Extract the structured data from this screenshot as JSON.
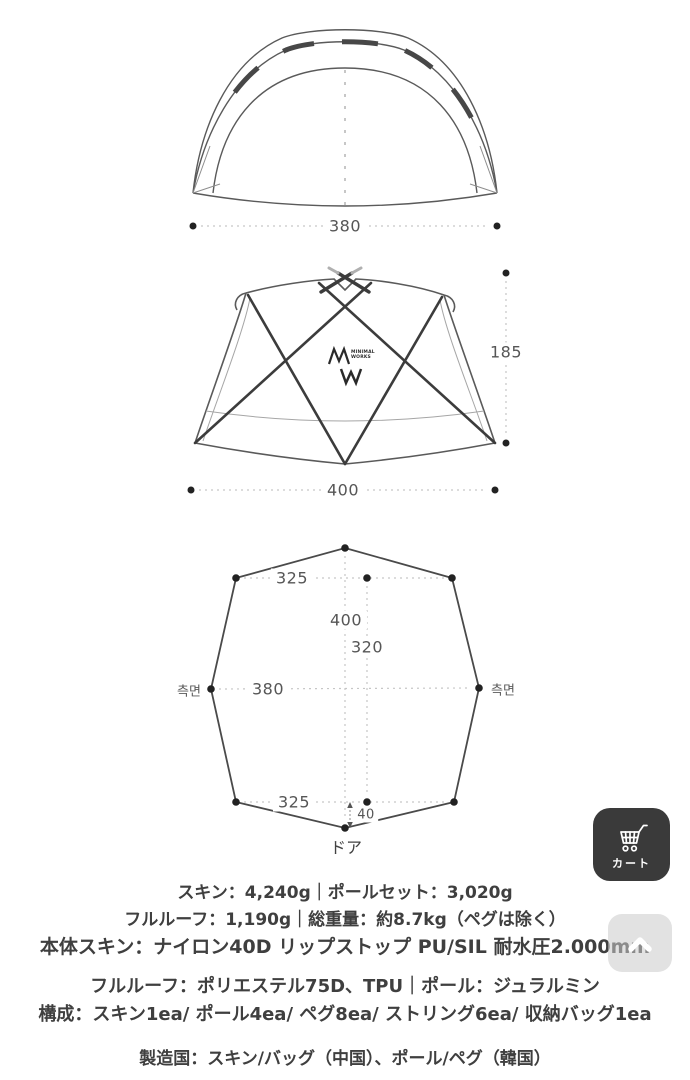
{
  "diagrams": {
    "front_view": {
      "width_dim": "380"
    },
    "side_view": {
      "height_dim": "185",
      "width_dim": "400",
      "logo_line1": "MINIMAL",
      "logo_line2": "WORKS"
    },
    "floor_plan": {
      "top_width_dim": "325",
      "length_dim": "400",
      "inner_length_dim": "320",
      "middle_width_dim": "380",
      "bottom_width_dim": "325",
      "door_offset_dim": "40",
      "side_label_left": "측면",
      "side_label_right": "측면",
      "door_label": "ドア"
    }
  },
  "specs": {
    "weight_line1": "スキン：4,240g｜ポールセット：3,020g",
    "weight_line2": "フルルーフ：1,190g｜総重量：約8.7kg（ペグは除く）",
    "material_line1": "本体スキン：ナイロン40D リップストップ PU/SIL 耐水圧2.000mm",
    "material_line2": "フルルーフ：ポリエステル75D、TPU｜ポール：ジュラルミン",
    "composition_line": "構成：スキン1ea/ ポール4ea/ ペグ8ea/ ストリング6ea/ 収納バッグ1ea",
    "origin_line": "製造国：スキン/バッグ（中国）、ポール/ペグ（韓国）"
  },
  "floating_buttons": {
    "cart_label": "カート"
  },
  "colors": {
    "line_dark": "#3c3c3c",
    "line_medium": "#5a5a5a",
    "line_light": "#a6a6a6",
    "dim_dotted": "#c6c6c6",
    "dot": "#222222",
    "spec_text": "#3f3f3f",
    "cart_bg": "#3a3a3a",
    "scroll_top_bg": "#cbcbcb"
  }
}
